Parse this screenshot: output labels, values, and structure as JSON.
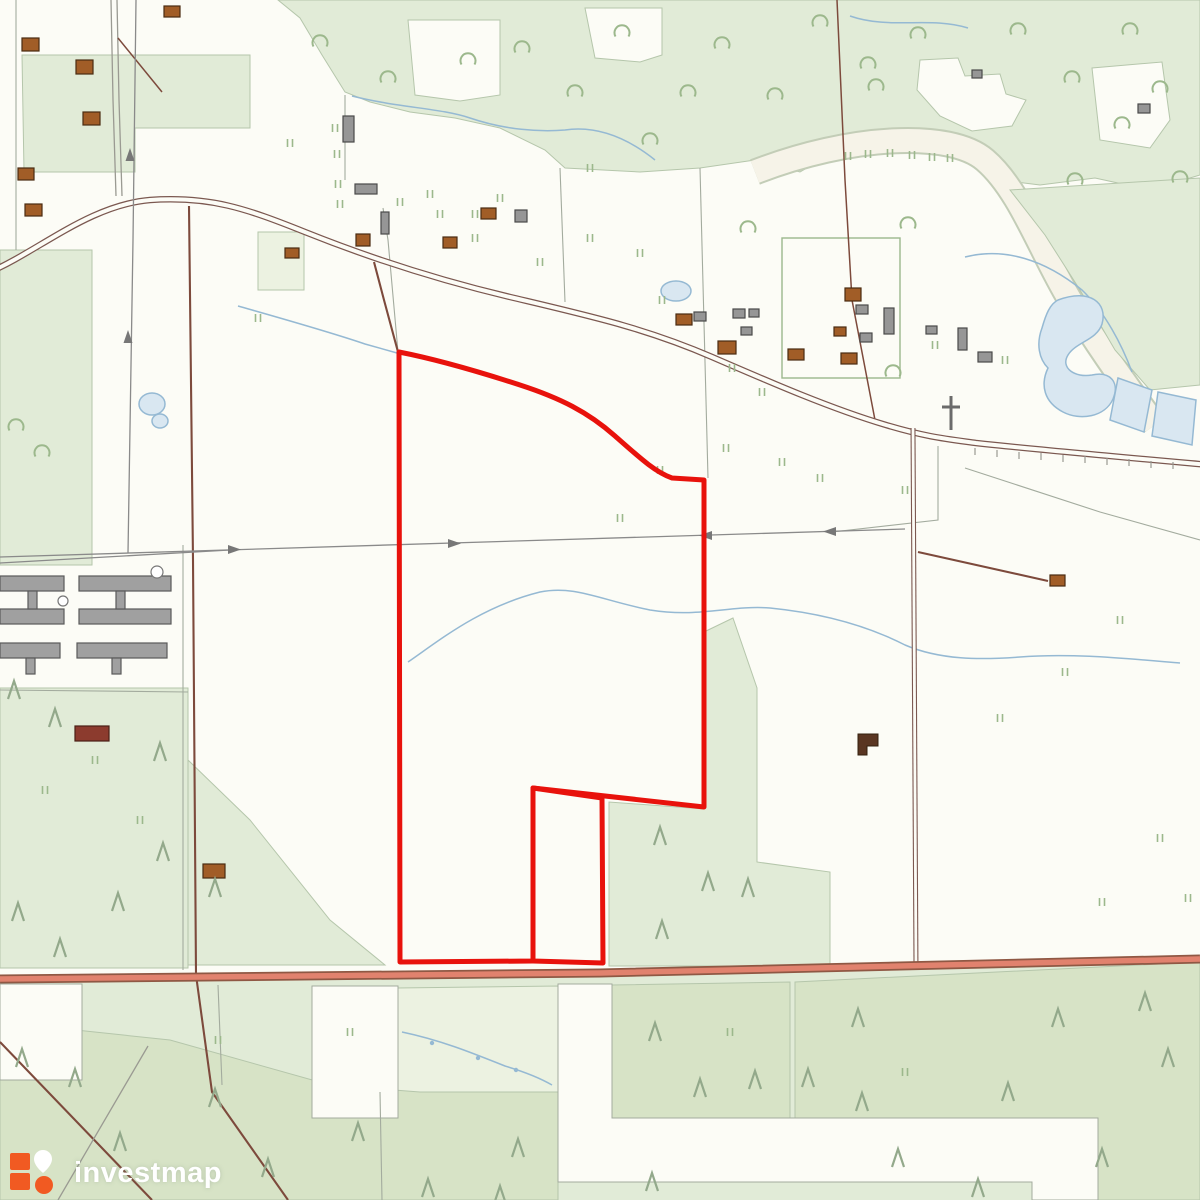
{
  "brand": {
    "name": "investmap"
  },
  "map": {
    "kind": "topographic parcel map",
    "highlighted_parcel_outline": "#e8120c"
  },
  "colors": {
    "bg": "#fcfcf6",
    "forest": "#e1ebd7",
    "forest-med": "#d7e3c6",
    "forest-pale": "#ecf2e1",
    "parcel-line": "#b5c6ab",
    "boundary": "#a3ab9e",
    "water-line": "#95b9d3",
    "water-fill": "#d9e7f1",
    "road-case": "#7b5850",
    "dirt": "#7d4a3c",
    "highway-case": "#8f5844",
    "highway-fill": "#e1826e",
    "powerline": "#8a8a8a",
    "bld-brown": "#a15d27",
    "bld-gray": "#969696",
    "tree": "#9cb88c",
    "conifer": "#93a98b",
    "boundary-red": "#e8120c",
    "logo-orange": "#f15a22",
    "logo-white": "#ffffff"
  }
}
